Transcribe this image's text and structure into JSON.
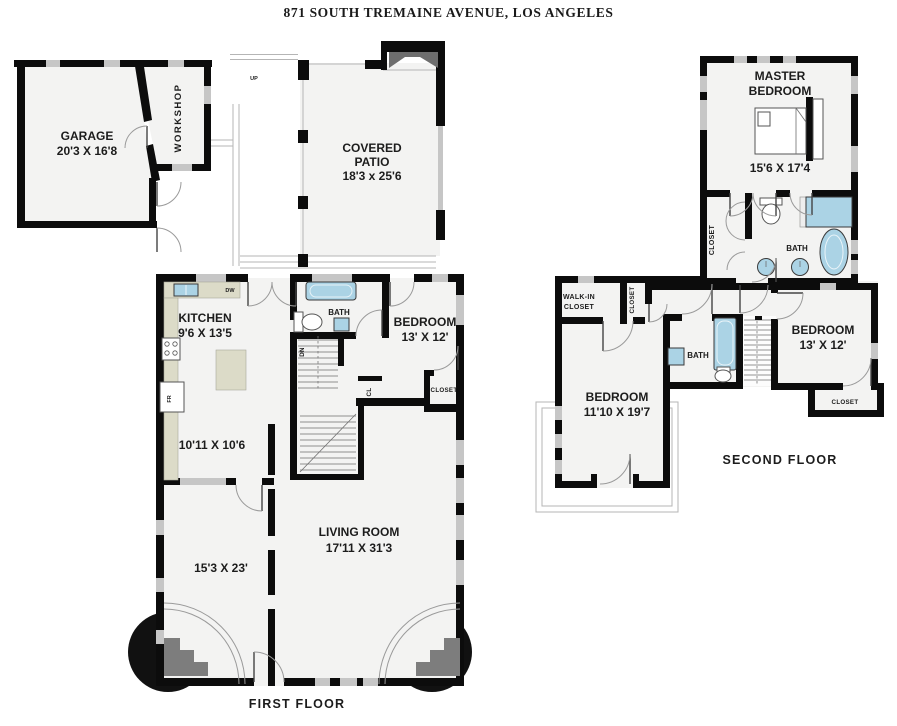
{
  "title": "871 SOUTH TREMAINE AVENUE, LOS ANGELES",
  "first_floor": {
    "caption": "FIRST FLOOR",
    "garage": {
      "name": "GARAGE",
      "dims": "20'3 X 16'8"
    },
    "workshop": {
      "name": "WORKSHOP"
    },
    "patio": {
      "line1": "COVERED",
      "line2": "PATIO",
      "dims": "18'3 x 25'6"
    },
    "kitchen": {
      "name": "KITCHEN",
      "dims": "9'6 X 13'5"
    },
    "bath": {
      "name": "BATH"
    },
    "bedroom": {
      "name": "BEDROOM",
      "dims": "13' X 12'"
    },
    "bedroom_closet": {
      "name": "CLOSET"
    },
    "dining": {
      "dims": "10'11 X 10'6"
    },
    "living": {
      "name": "LIVING ROOM",
      "dims": "17'11 X 31'3"
    },
    "front_room": {
      "dims": "15'3 X 23'"
    },
    "labels": {
      "dw": "DW",
      "fr": "FR",
      "dn": "DN",
      "cl": "CL",
      "up": "UP"
    }
  },
  "second_floor": {
    "caption": "SECOND FLOOR",
    "master": {
      "line1": "MASTER",
      "line2": "BEDROOM",
      "dims": "15'6 X 17'4"
    },
    "master_closet": {
      "name": "CLOSET"
    },
    "master_bath": {
      "name": "BATH"
    },
    "walkin": {
      "line1": "WALK-IN",
      "line2": "CLOSET"
    },
    "hall_closet": {
      "name": "CLOSET"
    },
    "hall_bath": {
      "name": "BATH"
    },
    "bedroom_right": {
      "name": "BEDROOM",
      "dims": "13' X 12'"
    },
    "bedroom_right_closet": {
      "name": "CLOSET"
    },
    "bedroom_left": {
      "name": "BEDROOM",
      "dims": "11'10 X 19'7"
    }
  },
  "colors": {
    "wall": "#0c0c0c",
    "room_fill": "#f3f3f2",
    "window": "#c6c6c6",
    "fixture": "#abd3e5",
    "counter": "#dcdbc8"
  }
}
